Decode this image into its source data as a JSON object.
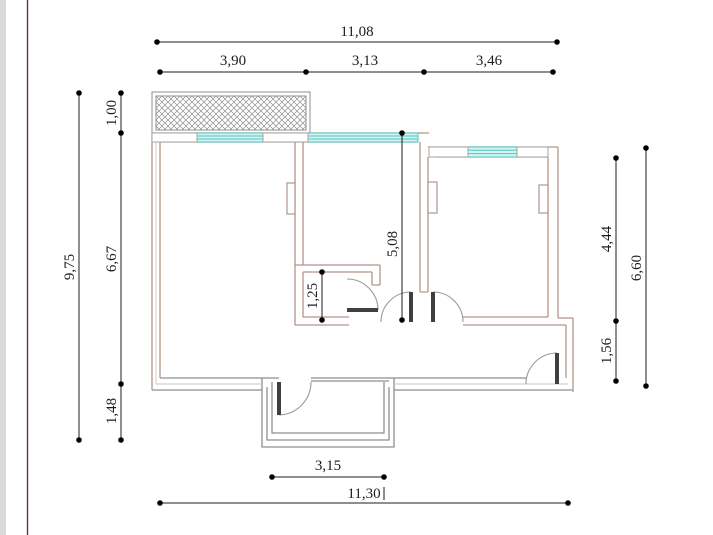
{
  "floor_plan": {
    "kind": "architectural-floor-plan",
    "dimensions": {
      "top_total": "11,08",
      "top_segments": [
        "3,90",
        "3,13",
        "3,46"
      ],
      "left_total": "9,75",
      "left_segments": [
        "1,00",
        "6,67",
        "1,48"
      ],
      "right_segments": [
        "4,44",
        "1,56"
      ],
      "right_total": "6,60",
      "hall_depth": "5,08",
      "closet_depth": "1,25",
      "porch_width": "3,15",
      "bottom_total": "11,30"
    },
    "colors": {
      "wall_tan": "#b2948a",
      "wall_tan_light": "#d9c9c1",
      "wall_gray": "#8f8f8c",
      "line_dark": "#1c1c1c",
      "window_stroke": "#4cc7c3",
      "window_fill": "#d6f3f1",
      "hatch": "#8f8f8f",
      "door_leaf": "#3f3f3f",
      "arc": "#9a9a98",
      "pier_stroke": "#a6a6a4",
      "edge_strip": "#d9d9d9",
      "margin_line": "#7a2a2a"
    }
  }
}
